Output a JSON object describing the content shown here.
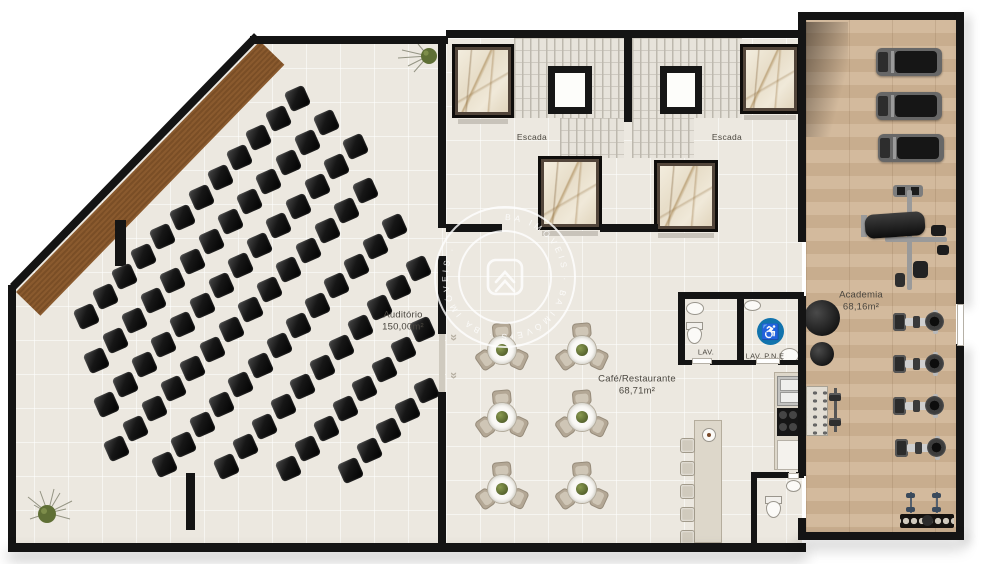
{
  "labels": {
    "auditorium_name": "Auditório",
    "auditorium_area": "150,00m²",
    "cafe_name": "Café/Restaurante",
    "cafe_area": "68,71m²",
    "gym_name": "Academia",
    "gym_area": "68,16m²",
    "stair_left": "Escada",
    "stair_right": "Escada",
    "lav": "LAV.",
    "lav_pne": "LAV. P.N.E"
  },
  "watermark": {
    "ring_text": "BA IMÓVEIS · BA IMÓVEIS · BA IMÓVEIS ·"
  },
  "icons": {
    "accessibility": "♿"
  },
  "colors": {
    "wall": "#141414",
    "floor": "#ece8e0",
    "wood_deck": "#8a5a2e",
    "gym_floor": "#cdb294",
    "accessibility_blue": "#1173ad",
    "seat_black": "#141414",
    "plant_green": "#5f6f35"
  },
  "floorplan": {
    "auditorium": {
      "seat_step": {
        "dx": 19.2,
        "dy": -19.8
      },
      "seat_size": 21,
      "seat_rotation": -24,
      "seat_rows": [
        {
          "x": 86,
          "y": 316,
          "count": 12
        },
        {
          "x": 96,
          "y": 360,
          "count": 13
        },
        {
          "x": 106,
          "y": 404,
          "count": 14
        },
        {
          "x": 116,
          "y": 448,
          "count": 14
        },
        {
          "x": 164,
          "y": 464,
          "count": 13
        },
        {
          "x": 226,
          "y": 466,
          "count": 11
        },
        {
          "x": 288,
          "y": 468,
          "count": 8
        },
        {
          "x": 350,
          "y": 470,
          "count": 5
        }
      ]
    },
    "cafe": {
      "tables": [
        {
          "x": 502,
          "y": 350
        },
        {
          "x": 582,
          "y": 350
        },
        {
          "x": 502,
          "y": 417
        },
        {
          "x": 582,
          "y": 417
        },
        {
          "x": 502,
          "y": 489
        },
        {
          "x": 582,
          "y": 489
        }
      ],
      "chair_angles": [
        355,
        115,
        235
      ],
      "bar_stools": {
        "x": 680,
        "y_start": 438,
        "step": 23,
        "count": 5
      }
    },
    "core": {
      "elevators": [
        {
          "x": 452,
          "y": 44,
          "w": 62,
          "h": 74
        },
        {
          "x": 538,
          "y": 156,
          "w": 64,
          "h": 74
        },
        {
          "x": 740,
          "y": 44,
          "w": 60,
          "h": 70
        },
        {
          "x": 654,
          "y": 160,
          "w": 64,
          "h": 72
        }
      ]
    },
    "gym": {
      "treadmills": [
        {
          "x": 876,
          "y": 48
        },
        {
          "x": 876,
          "y": 92
        },
        {
          "x": 878,
          "y": 134
        }
      ],
      "bikes": [
        {
          "x": 893,
          "y": 310
        },
        {
          "x": 893,
          "y": 352
        },
        {
          "x": 893,
          "y": 394
        },
        {
          "x": 895,
          "y": 436
        }
      ],
      "balls": [
        {
          "x": 804,
          "y": 300,
          "d": 36
        },
        {
          "x": 810,
          "y": 342,
          "d": 24
        }
      ],
      "small_dumbbells": [
        {
          "x": 906,
          "y": 492
        },
        {
          "x": 932,
          "y": 492
        }
      ]
    }
  }
}
